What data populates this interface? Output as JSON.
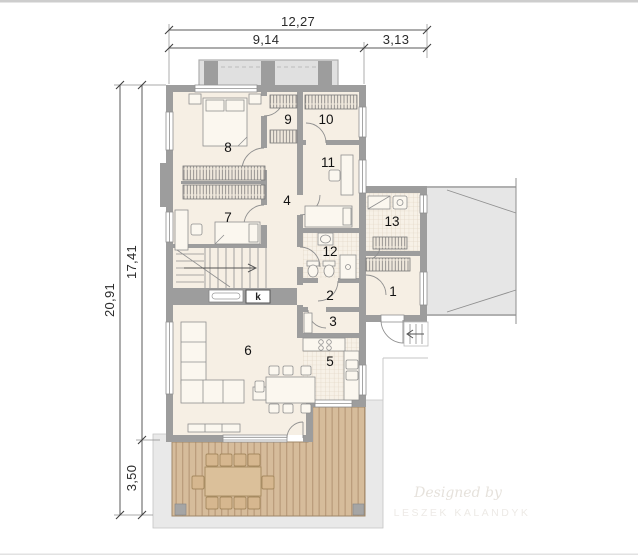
{
  "dims": {
    "total_width": "12,27",
    "left_span": "9,14",
    "right_span": "3,13",
    "total_height": "20,91",
    "upper_span": "17,41",
    "lower_span": "3,50"
  },
  "rooms": [
    "1",
    "2",
    "3",
    "4",
    "5",
    "6",
    "7",
    "8",
    "9",
    "10",
    "11",
    "12",
    "13"
  ],
  "fireplace": {
    "label": "k"
  },
  "watermark": {
    "line1": "Designed by",
    "line2": "LESZEK KALANDYK"
  },
  "colors": {
    "wall": "#9d9d9d",
    "floor": "#f6efe4",
    "deck": "#d6bc9b",
    "paving": "#e9e9e9",
    "balcony": "#e0e0e0",
    "roof_overhang": "#e6e6e6"
  }
}
